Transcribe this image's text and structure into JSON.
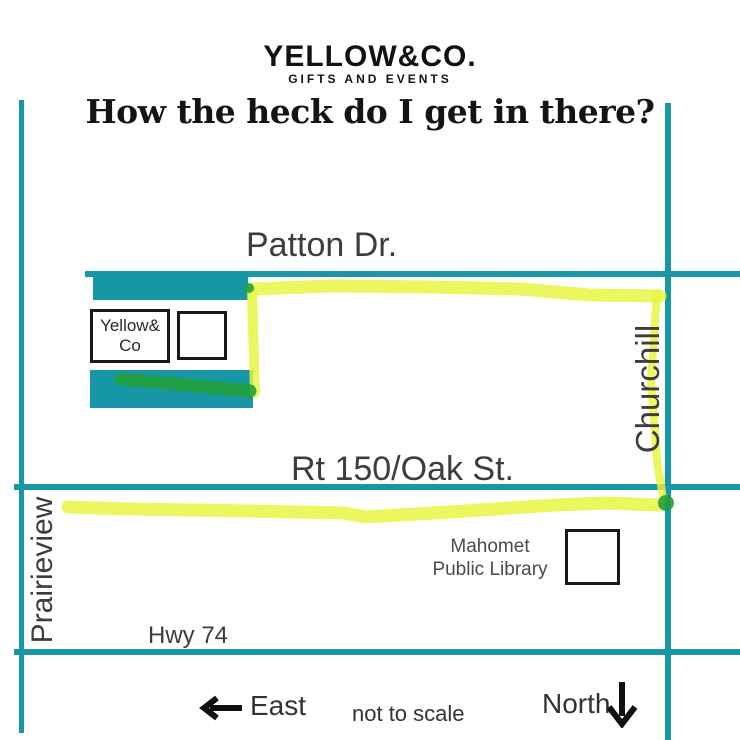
{
  "brand": {
    "name": "YELLOW&CO.",
    "tagline": "GIFTS AND EVENTS"
  },
  "title": "How the heck do I get in there?",
  "map": {
    "road_labels": {
      "patton": "Patton Dr.",
      "rt150": "Rt 150/Oak St.",
      "hwy74": "Hwy 74",
      "churchill": "Churchill",
      "prairieview": "Prairieview"
    },
    "buildings": {
      "store_line1": "Yellow&",
      "store_line2": "Co",
      "library_line1": "Mahomet",
      "library_line2": "Public Library"
    },
    "colors": {
      "road_teal": "#1797a6",
      "route_highlight_yellow": "#e8f43c",
      "route_highlight_green": "#22a03c",
      "ink_black": "#141414"
    }
  },
  "footer": {
    "east_label": "East",
    "scale_note": "not to scale",
    "north_label": "North"
  }
}
